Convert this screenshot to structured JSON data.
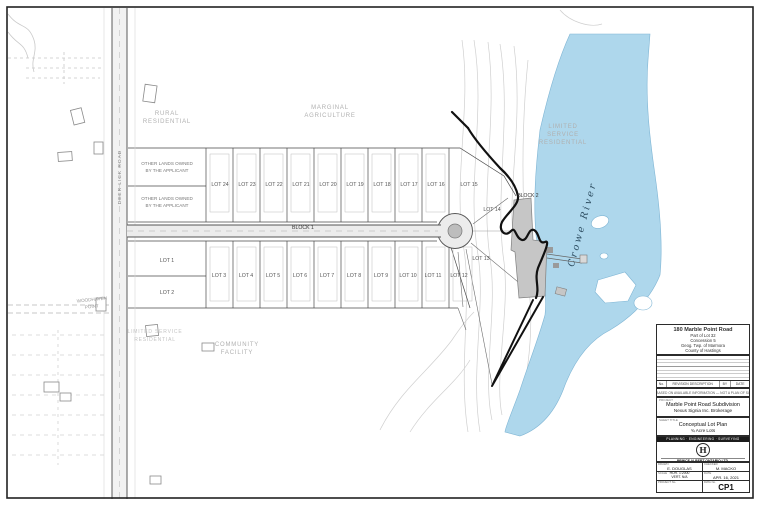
{
  "colors": {
    "water": "#aed7ec",
    "line": "#2b2b2b",
    "faint": "#c9c9c9",
    "building_fill": "#c6c6c6"
  },
  "plan": {
    "zones": {
      "rural": [
        "RURAL",
        "RESIDENTIAL"
      ],
      "marginal": [
        "MARGINAL",
        "AGRICULTURE"
      ],
      "limited": [
        "LIMITED",
        "SERVICE",
        "RESIDENTIAL"
      ],
      "limited_sw": [
        "LIMITED SERVICE",
        "RESIDENTIAL"
      ],
      "community": [
        "COMMUNITY",
        "FACILITY"
      ],
      "other_lands": [
        "OTHER LANDS OWNED",
        "BY THE APPLICANT"
      ]
    },
    "roads": {
      "deer_lick": "DEER LICK ROAD",
      "woodhaven": [
        "WOODHAVEN",
        "POINT"
      ],
      "block1": "BLOCK 1",
      "block2": "BLOCK 2"
    },
    "river_label": "Crowe River",
    "lots": [
      "LOT 1",
      "LOT 2",
      "LOT 3",
      "LOT 4",
      "LOT 5",
      "LOT 6",
      "LOT 7",
      "LOT 8",
      "LOT 9",
      "LOT 10",
      "LOT 11",
      "LOT 12",
      "LOT 13",
      "LOT 14",
      "LOT 15",
      "LOT 16",
      "LOT 17",
      "LOT 18",
      "LOT 19",
      "LOT 20",
      "LOT 21",
      "LOT 22",
      "LOT 23",
      "LOT 24"
    ]
  },
  "titleblock": {
    "address": [
      "180 Marble Point Road",
      "Part of Lot 32",
      "Concession 5",
      "Geog. Twp. of Marmora",
      "County of Hastings"
    ],
    "revision": {
      "col_no": "No.",
      "col_desc": "REVISION DESCRIPTION",
      "col_by": "BY",
      "col_date": "DATE"
    },
    "note": "PLAN BASED ON AVAILABLE INFORMATION — NOT A PLAN OF SURVEY",
    "project_label": "PROJECT",
    "project_line1": "Marble Point Road Subdivision",
    "project_line2": "Nexus Signia Inc. Brokerage",
    "title_label": "SHEET TITLE",
    "title_line1": "Conceptual Lot Plan",
    "title_line2": "¾ Acre Lots",
    "banner": "PLANNING · ENGINEERING · SURVEYING",
    "logo_letter": "H",
    "company": "PRINCE ALBERT ONTARIO LTD.",
    "fields": {
      "drawn_label": "DRAWN",
      "drawn": "E. DOUGLAS",
      "checked_label": "CHECKED",
      "checked": "M. MACKO",
      "scale_label": "SCALE",
      "scale_line1": "HOR. 1:2000",
      "scale_line2": "VERT. N/A",
      "date_label": "DATE",
      "date": "APR. 16, 2021",
      "project_no_label": "PROJECT No.",
      "dwg_label": "DWG No.",
      "dwg": "CP1"
    }
  }
}
